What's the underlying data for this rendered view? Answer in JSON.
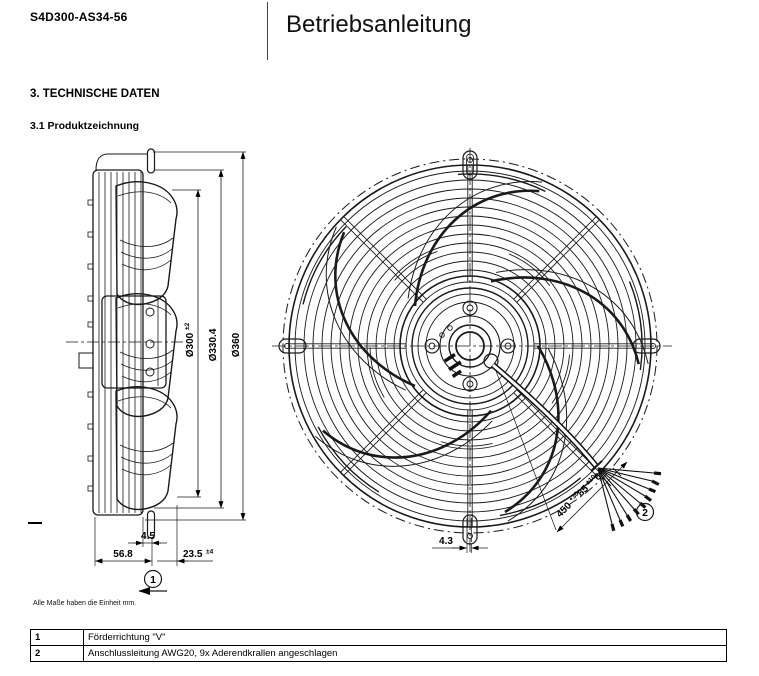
{
  "header": {
    "part_number": "S4D300-AS34-56",
    "title": "Betriebsanleitung"
  },
  "sections": {
    "heading": "3. TECHNISCHE DATEN",
    "subheading": "3.1 Produktzeichnung"
  },
  "note": {
    "units": "Alle Maße haben die Einheit mm."
  },
  "side_view": {
    "dia300": "Ø300",
    "dia300_tol": "±2",
    "dia330": "Ø330.4",
    "dia360": "Ø360",
    "depth_flange": "4.5",
    "depth_housing": "56.8",
    "blade_protrusion": "23.5",
    "blade_protrusion_tol": "±4",
    "callout": "1"
  },
  "front_view": {
    "tab_width": "4.3",
    "cable_length": "450",
    "cable_length_tol": "+30",
    "strip_length": "85",
    "strip_length_tol": "±10",
    "end_length": "6",
    "callout": "2"
  },
  "legend": {
    "rows": [
      {
        "num": "1",
        "text": "Förderrichtung \"V\""
      },
      {
        "num": "2",
        "text": "Anschlussleitung AWG20, 9x Aderendkrallen angeschlagen"
      }
    ]
  }
}
